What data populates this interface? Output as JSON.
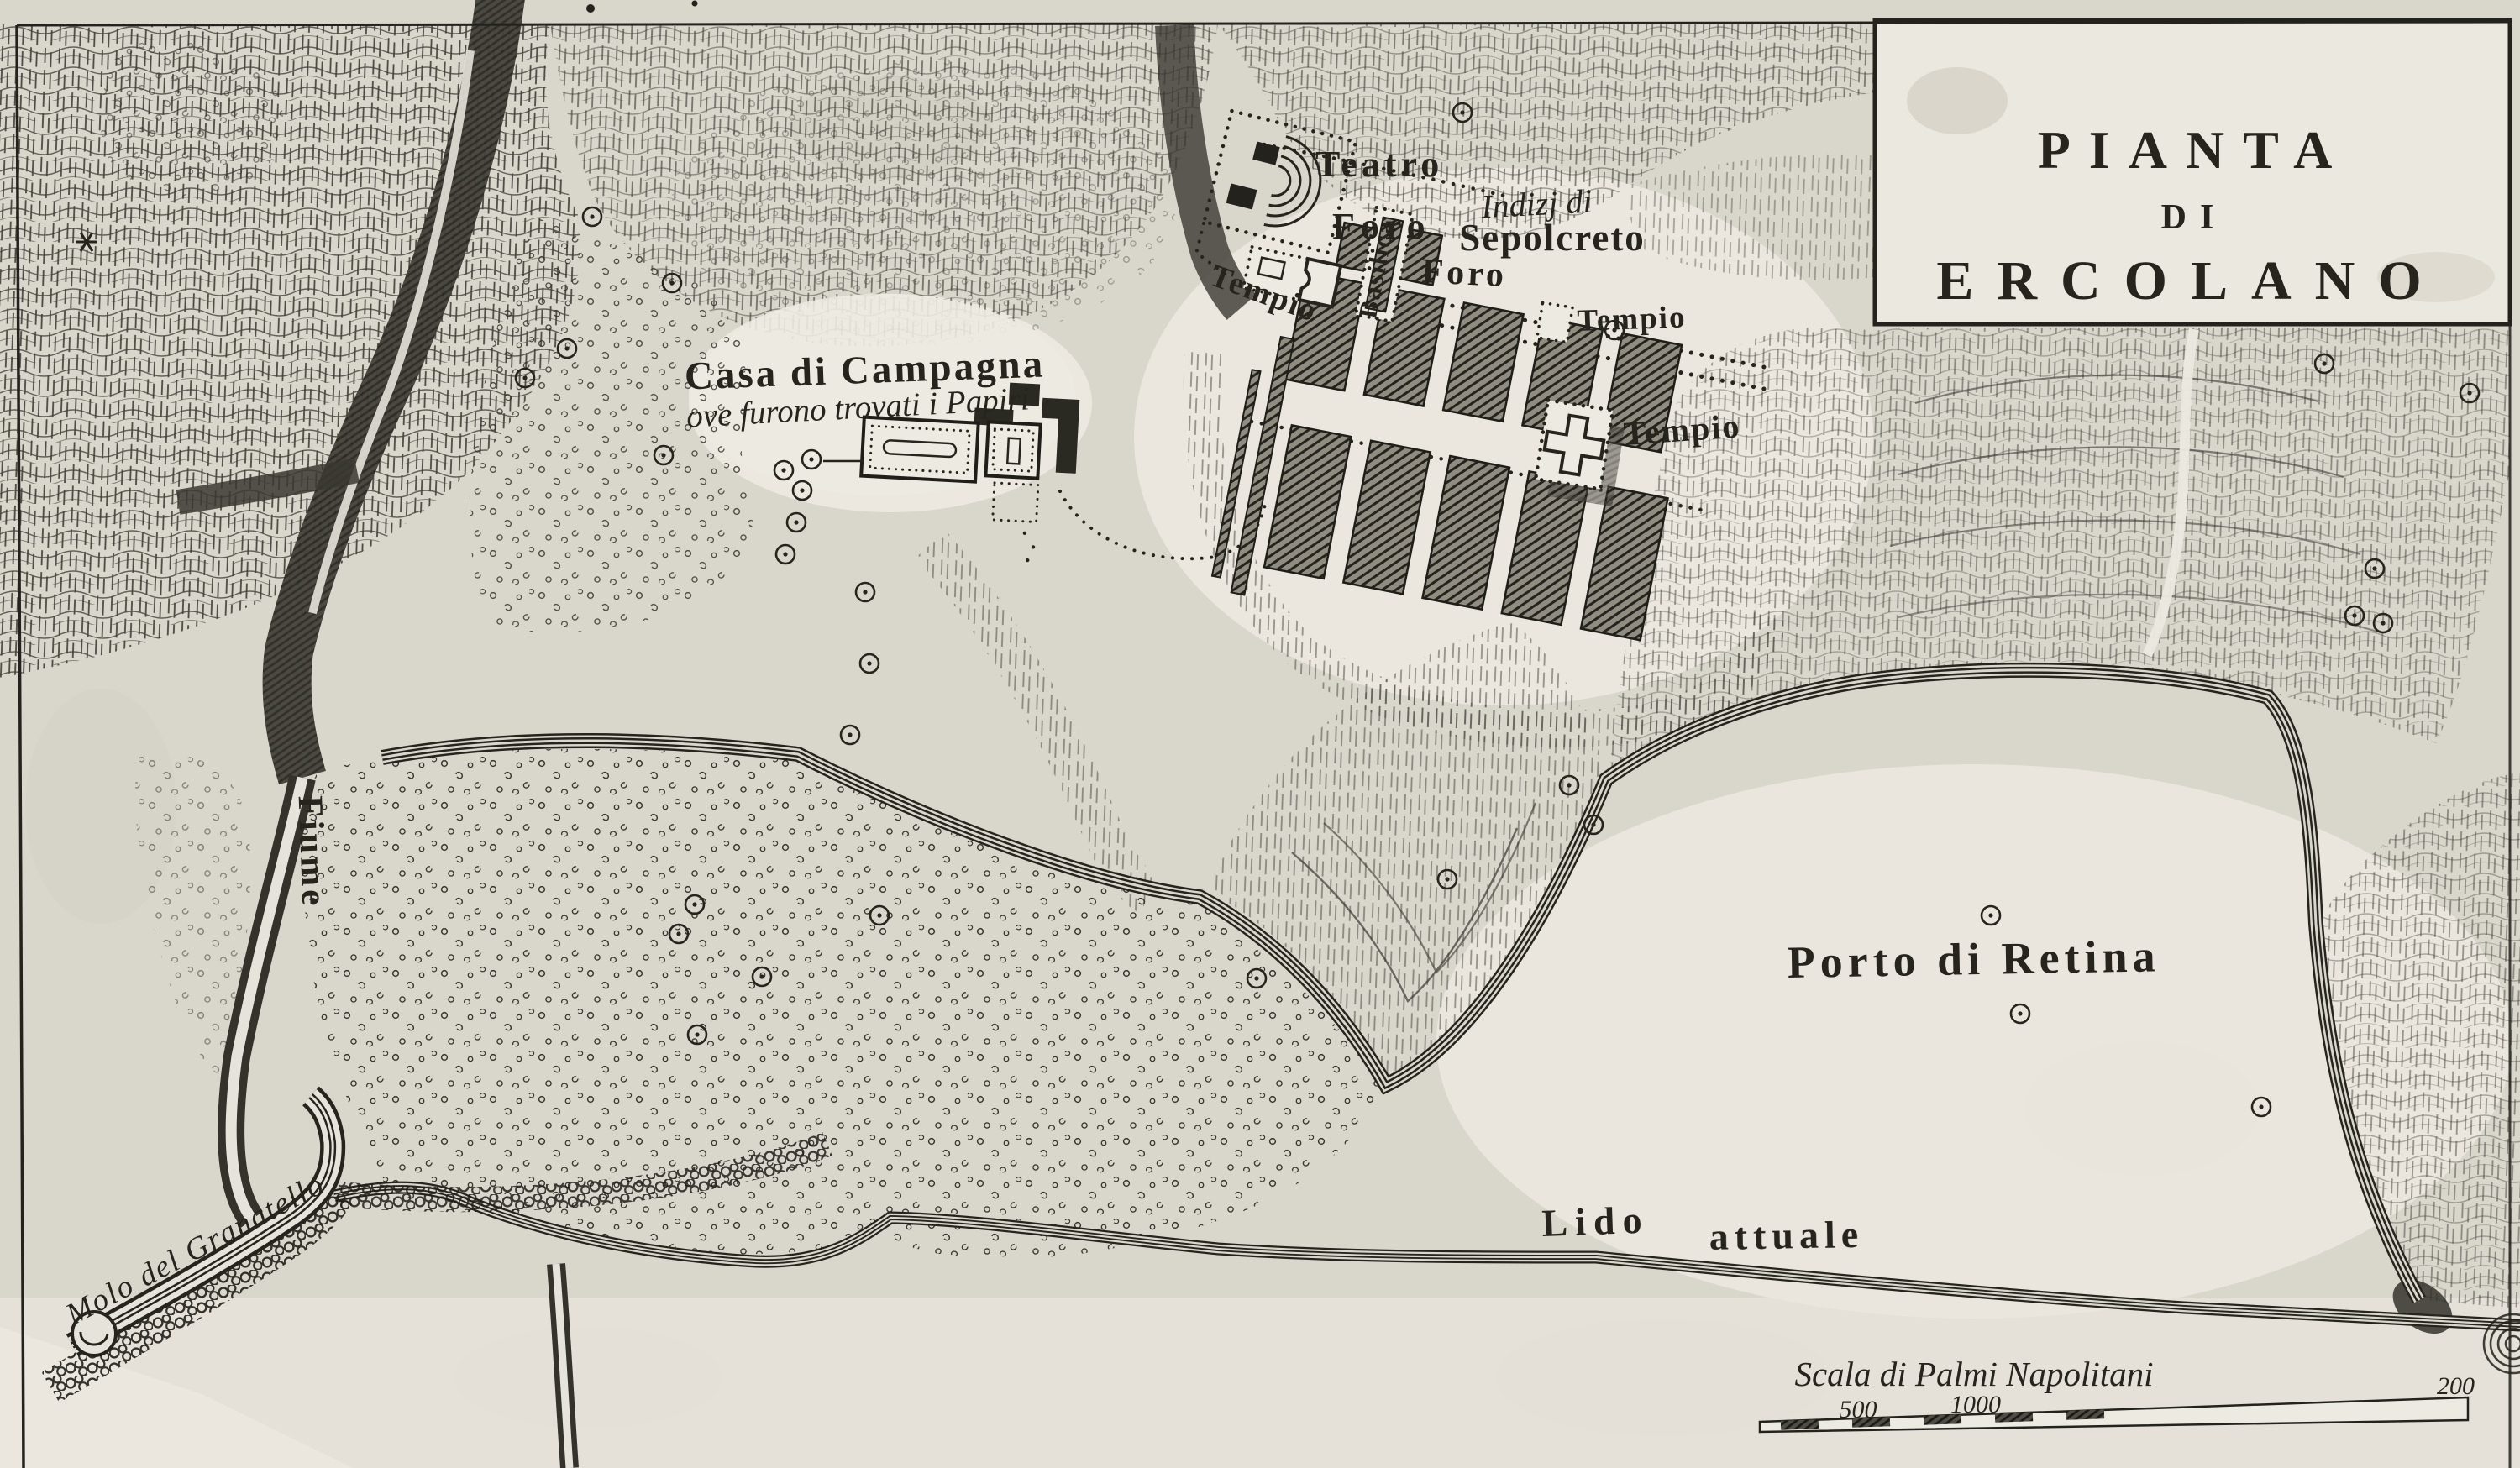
{
  "map": {
    "kind": "antique engraved plan of Herculaneum",
    "colors": {
      "paper": "#d9d6cc",
      "paper_light": "#edeae1",
      "ink": "#26241d"
    }
  },
  "title_box": {
    "line1": "PIANTA",
    "line2": "DI",
    "line3": "ERCOLANO"
  },
  "labels": {
    "teatro": "Teatro",
    "foro_upper": "Foro",
    "foro_lower": "Foro",
    "basilica": "Basilica",
    "tempio_left": "Tempio",
    "tempio_upper_right": "Tempio",
    "tempio_cross": "Tempio",
    "sepolcreto_line1": "Indizj di",
    "sepolcreto_line2": "Sepolcreto",
    "casa_di_campagna": "Casa di Campagna",
    "casa_subtitle": "ove furono trovati i Papiri",
    "fiume": "Fiume",
    "porto_di_retina": "Porto di Retina",
    "lido_word1": "Lido",
    "lido_word2": "attuale",
    "molo": "Molo del Granatello"
  },
  "scale_bar": {
    "title": "Scala di Palmi Napolitani",
    "tick1": "500",
    "tick2": "1000",
    "tick3": "200"
  }
}
